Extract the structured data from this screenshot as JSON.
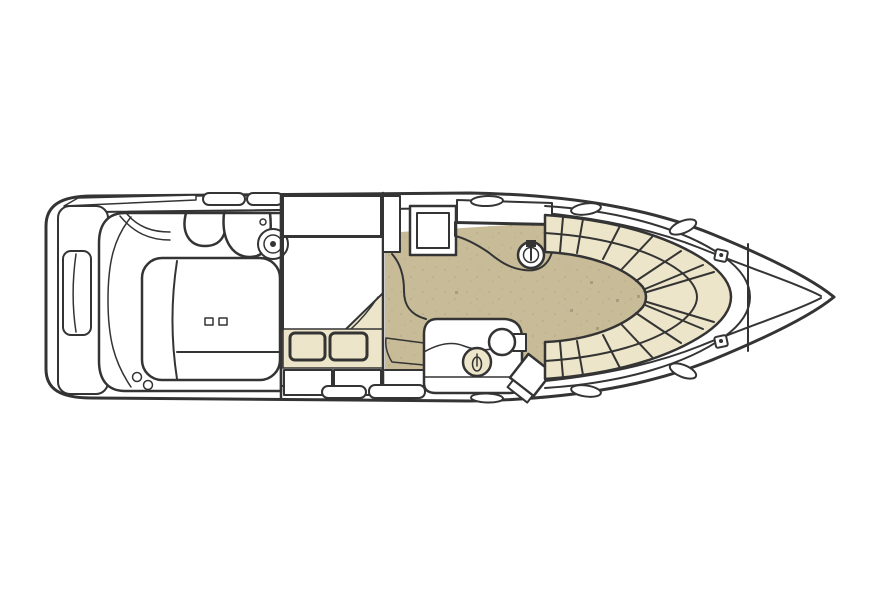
{
  "diagram": {
    "type": "boat-floor-plan",
    "view": "top-down interior and deck layout, bow pointing right"
  },
  "colors": {
    "background": "#ffffff",
    "line": "#343434",
    "deck_white": "#ffffff",
    "carpet_tan": "#c7bb98",
    "carpet_dot": "#a79c7c",
    "cushion_cream": "#ece5c9",
    "comforter_base": "#3d3f34",
    "comforter_motif": "#888a70",
    "granite_base": "#3b222d",
    "granite_speckle": "#e8d6d9",
    "granite_speckle2": "#b2808f"
  },
  "regions": {
    "hull": "hull outline",
    "swim_platform": "swim platform",
    "transom_seat": "transom seat",
    "cockpit": "cockpit",
    "helm_seats": "helm and companion seats",
    "cockpit_settee": "cockpit settee and engine hatch",
    "mid_cabin": "mid cabin berth",
    "comforter": "patterned berth comforter",
    "pillows": "berth pillows",
    "drawers": "storage drawers",
    "companionway": "companionway steps",
    "galley": "galley counter with sink",
    "appliance": "galley appliance",
    "salon": "salon carpet",
    "head": "head compartment",
    "head_sink": "head sink",
    "toilet": "toilet",
    "shower_door": "shower door panel",
    "bow_dinette": "bow dinette seating",
    "bow_floor": "bow dinette floor",
    "deck_hatches": "deck hatches",
    "cleats": "deck cleats",
    "anchor_bulkhead": "anchor locker bulkhead"
  }
}
